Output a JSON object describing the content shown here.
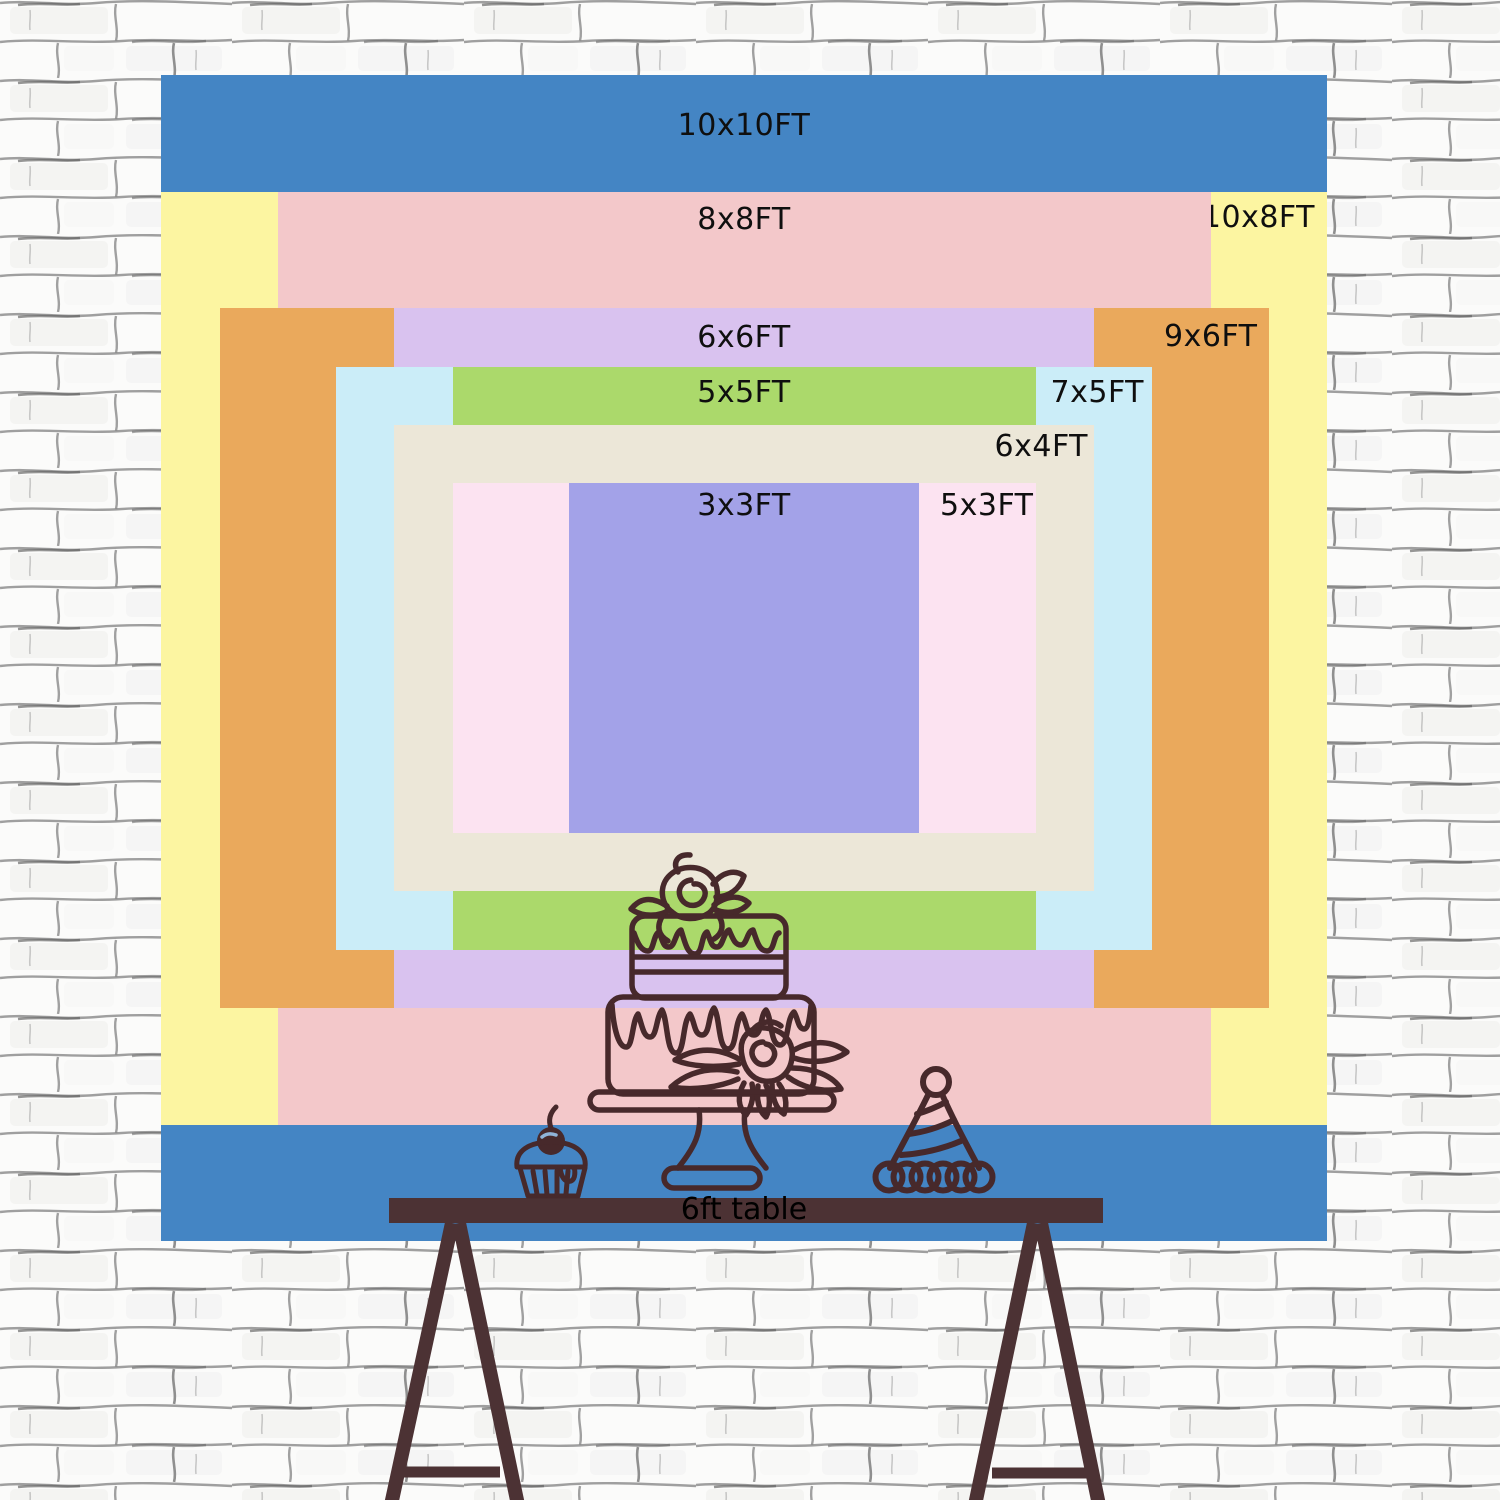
{
  "backdrop": {
    "unit": "FT",
    "label_color": "#0f0f0f",
    "sizes": [
      {
        "id": "10x10",
        "label": "10x10FT",
        "w_ft": 10,
        "h_ft": 10,
        "color": "#4485c4"
      },
      {
        "id": "10x8",
        "label": "10x8FT",
        "w_ft": 10,
        "h_ft": 8,
        "color": "#fcf5a1"
      },
      {
        "id": "8x8",
        "label": "8x8FT",
        "w_ft": 8,
        "h_ft": 8,
        "color": "#f3c8ca"
      },
      {
        "id": "9x6",
        "label": "9x6FT",
        "w_ft": 9,
        "h_ft": 6,
        "color": "#eaa95c"
      },
      {
        "id": "6x6",
        "label": "6x6FT",
        "w_ft": 6,
        "h_ft": 6,
        "color": "#d9c2ef"
      },
      {
        "id": "7x5",
        "label": "7x5FT",
        "w_ft": 7,
        "h_ft": 5,
        "color": "#cbedf8"
      },
      {
        "id": "5x5",
        "label": "5x5FT",
        "w_ft": 5,
        "h_ft": 5,
        "color": "#abd96b"
      },
      {
        "id": "6x4",
        "label": "6x4FT",
        "w_ft": 6,
        "h_ft": 4,
        "color": "#ece7d8"
      },
      {
        "id": "5x3",
        "label": "5x3FT",
        "w_ft": 5,
        "h_ft": 3,
        "color": "#fce3f1"
      },
      {
        "id": "3x3",
        "label": "3x3FT",
        "w_ft": 3,
        "h_ft": 3,
        "color": "#a3a2e8"
      }
    ]
  },
  "table": {
    "label": "6ft table",
    "color": "#4c3234"
  },
  "illustration": {
    "line_color": "#47292b"
  },
  "wall": {
    "base_color": "#fbfbfa",
    "mortar_color": "#8f8f8f"
  }
}
